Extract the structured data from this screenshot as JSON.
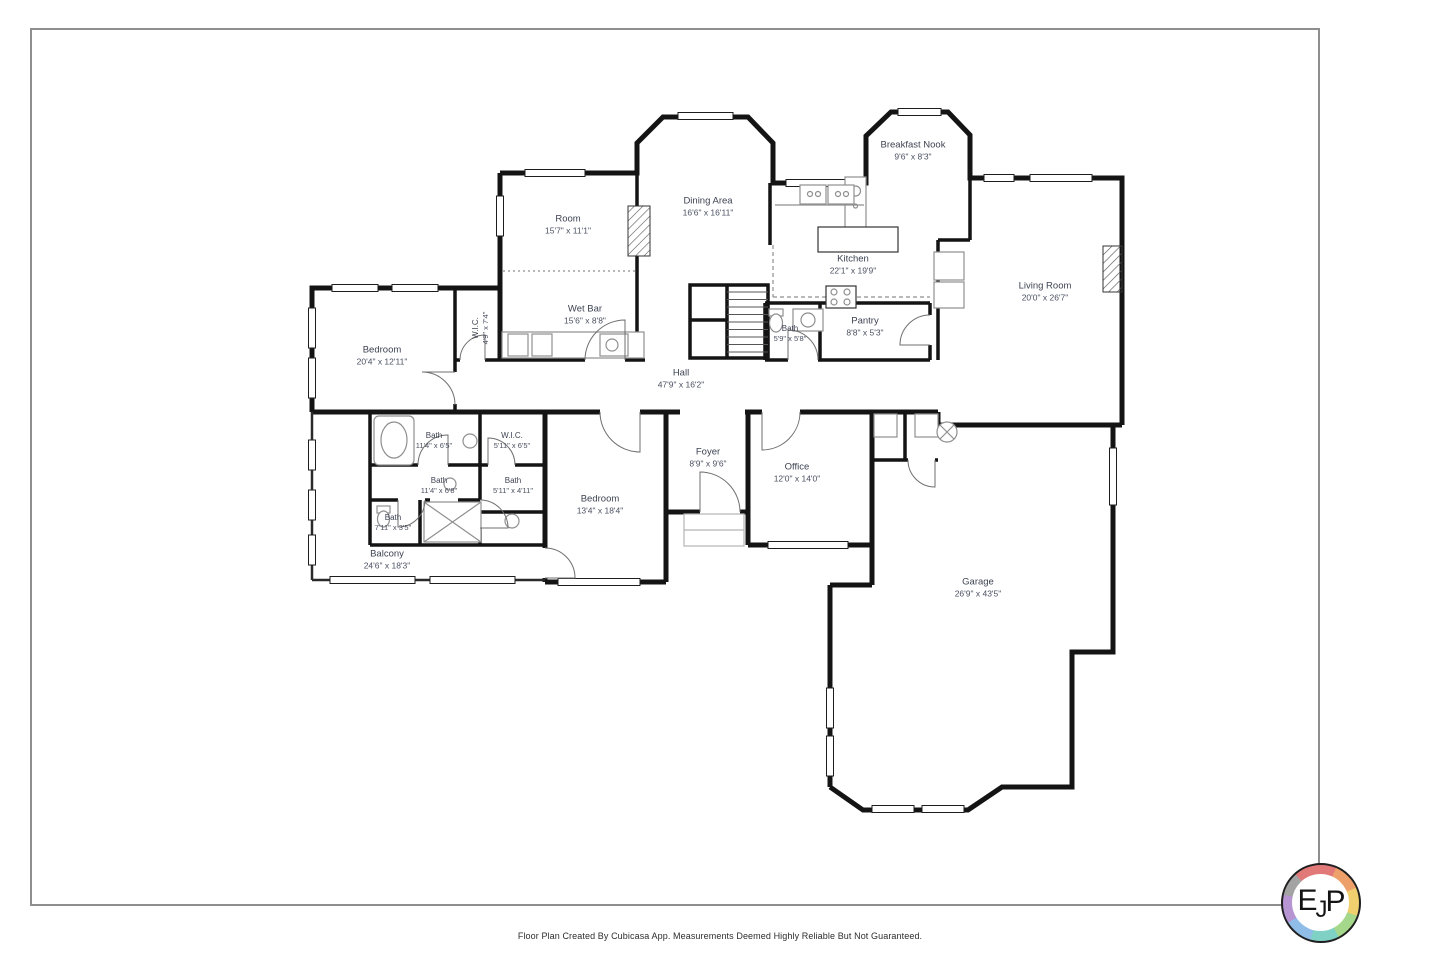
{
  "page": {
    "footer": "Floor Plan Created By Cubicasa App. Measurements Deemed Highly Reliable But Not Guaranteed."
  },
  "colors": {
    "wall": "#141414",
    "fixture": "#8f8f8f",
    "label_text": "#3d4352",
    "page_border": "#8f8f8f",
    "logo_ring": [
      "#e27979",
      "#eda06a",
      "#f0d06e",
      "#a6d88c",
      "#7fd0c5",
      "#8fbde8",
      "#b795d2",
      "#a3a3a3"
    ]
  },
  "logo": {
    "letters": [
      "E",
      "J",
      "P"
    ]
  },
  "rooms": [
    {
      "name": "Breakfast Nook",
      "dims": "9'6\" x 8'3\""
    },
    {
      "name": "Dining Area",
      "dims": "16'6\" x 16'11\""
    },
    {
      "name": "Room",
      "dims": "15'7\" x 11'1\""
    },
    {
      "name": "Kitchen",
      "dims": "22'1\" x 19'9\""
    },
    {
      "name": "Living Room",
      "dims": "20'0\" x 26'7\""
    },
    {
      "name": "Wet Bar",
      "dims": "15'6\" x 8'8\""
    },
    {
      "name": "Pantry",
      "dims": "8'8\" x 5'3\""
    },
    {
      "name": "Bath",
      "dims": "5'9\" x 5'8\""
    },
    {
      "name": "Bedroom",
      "dims": "20'4\" x 12'11\""
    },
    {
      "name": "W.I.C.",
      "dims": "4'9\" x 7'4\""
    },
    {
      "name": "Hall",
      "dims": "47'9\" x 16'2\""
    },
    {
      "name": "Foyer",
      "dims": "8'9\" x 9'6\""
    },
    {
      "name": "Office",
      "dims": "12'0\" x 14'0\""
    },
    {
      "name": "Bath",
      "dims": "11'4\" x 6'5\""
    },
    {
      "name": "W.I.C.",
      "dims": "5'11\" x 6'5\""
    },
    {
      "name": "Bath",
      "dims": "11'4\" x 6'8\""
    },
    {
      "name": "Bath",
      "dims": "5'11\" x 4'11\""
    },
    {
      "name": "Bath",
      "dims": "7'11\" x 3'5\""
    },
    {
      "name": "Bedroom",
      "dims": "13'4\" x 18'4\""
    },
    {
      "name": "Balcony",
      "dims": "24'6\" x 18'3\""
    },
    {
      "name": "Garage",
      "dims": "26'9\" x 43'5\""
    }
  ]
}
